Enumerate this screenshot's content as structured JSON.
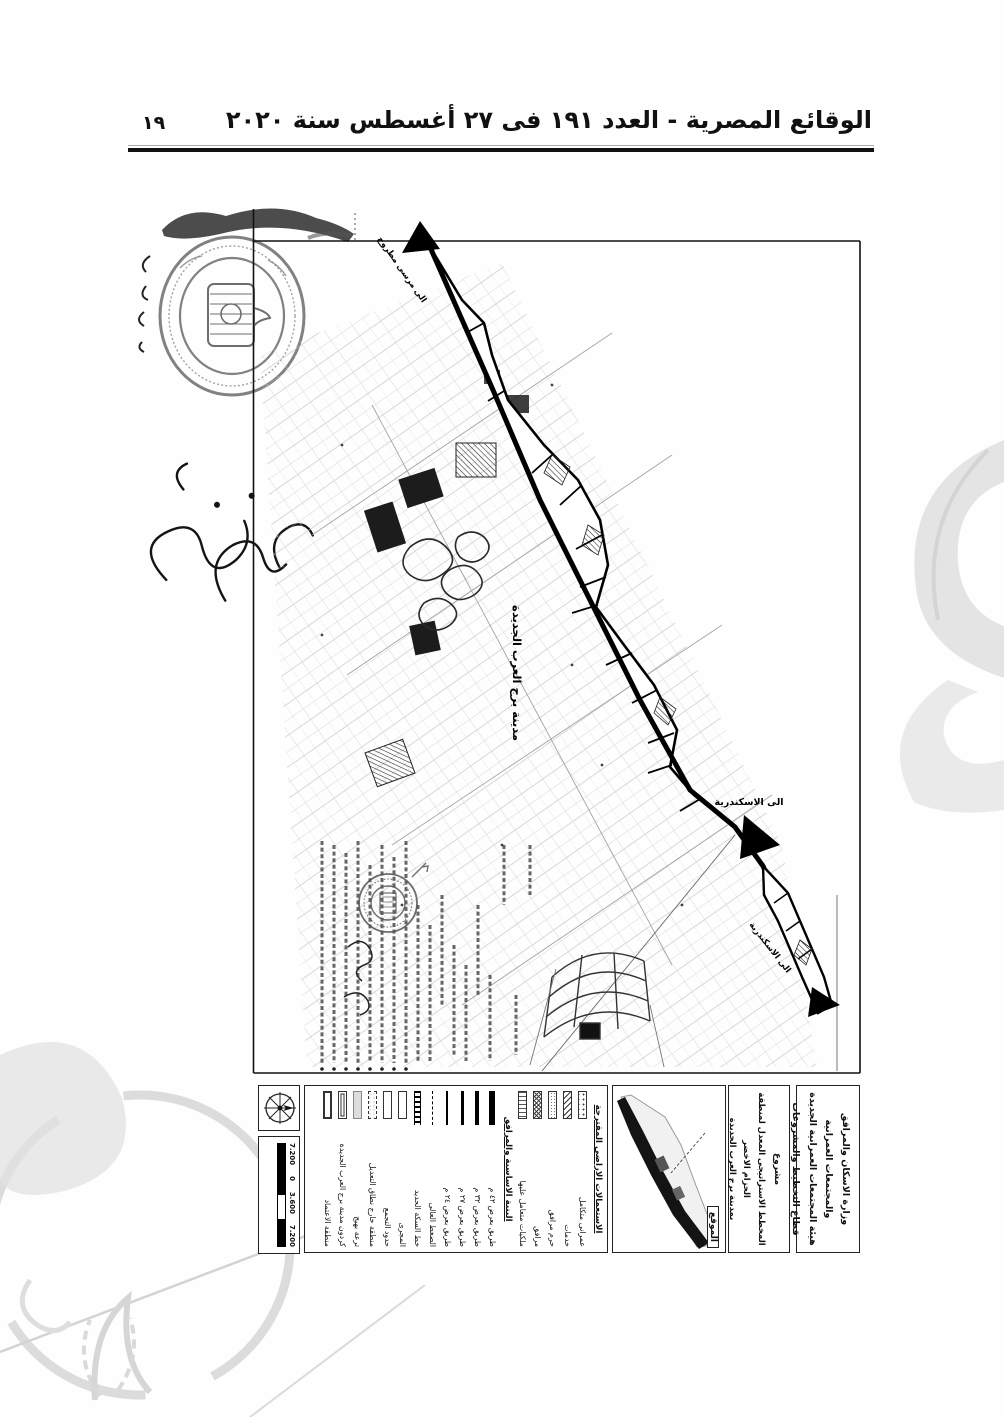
{
  "header": {
    "title": "الوقائع المصرية - العدد ١٩١ فى ٢٧ أغسطس سنة ٢٠٢٠",
    "page_number": "١٩"
  },
  "map": {
    "city_label": "مدينة برج العرب الجديدة",
    "direction_top": "الى مرسى مطروح",
    "direction_mid": "الى الاسكندرية",
    "direction_bottom": "الى الاسكندرية"
  },
  "title_block": {
    "ministry": {
      "line1": "وزارة الاسكان والمرافق والمجتمعات العمرانية",
      "line2": "هيئة المجتمعات العمرانية الجديدة",
      "line3": "قطاع التخطيط والمشروعات"
    },
    "project": {
      "label": "مشروع",
      "line1": "المخطط الاستراتيجى المعدل لمنطقة الحزام الاخضر",
      "line2": "بمدينة برج العرب الجديدة"
    },
    "location_label": "الموقع",
    "legend": {
      "land_use_header": "الاستعمالات الاراضى المقترحة",
      "land_use_items": [
        "عمرانى متكامل",
        "خدمات",
        "حرم مرافق",
        "مرافق",
        "ملكيات متعامل عليها"
      ],
      "infrastructure_header": "البنية الاساسية والمرافق",
      "infrastructure_items": [
        "طريق بعرض ٤٢ م",
        "طريق بعرض ٣٢ م",
        "طريق بعرض ٢٧ م",
        "طريق بعرض ٢٤ م",
        "الضغط العالى",
        "خط السكة الحديد",
        "المجرى",
        "حدود التجمع",
        "منطقة خارج نطاق التعديل",
        "ترعة بهيج",
        "كردون مدينة برج العرب الجديدة",
        "منطقة الاعتماد"
      ]
    },
    "scale_bar": {
      "v1": "7.200",
      "v2": "3.600",
      "v3": "0",
      "v4": "7.200"
    }
  },
  "colors": {
    "ink": "#1a1a1a",
    "watermark": "#d6d6d6"
  }
}
